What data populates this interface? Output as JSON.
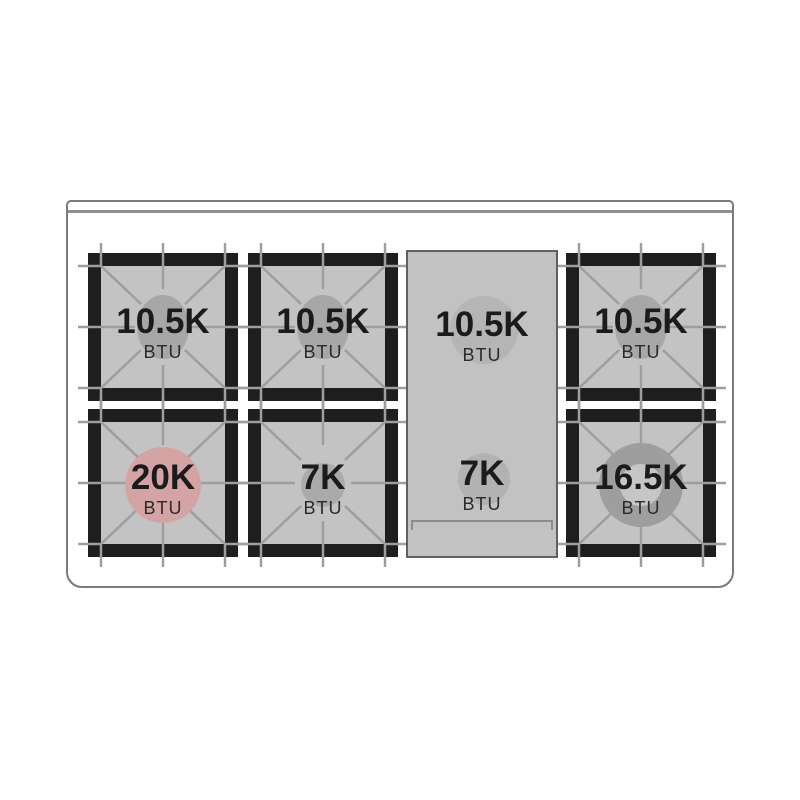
{
  "diagram": {
    "title": "Gas range cooktop burner layout",
    "unit": "BTU"
  },
  "burners": [
    {
      "position": "rear-left",
      "value": "10.5K",
      "unit": "BTU",
      "indicator": "gray-oval"
    },
    {
      "position": "rear-center-left",
      "value": "10.5K",
      "unit": "BTU",
      "indicator": "gray-oval"
    },
    {
      "position": "griddle-rear",
      "value": "10.5K",
      "unit": "BTU",
      "indicator": "gray-circle"
    },
    {
      "position": "rear-right",
      "value": "10.5K",
      "unit": "BTU",
      "indicator": "gray-oval"
    },
    {
      "position": "front-left",
      "value": "20K",
      "unit": "BTU",
      "indicator": "red-circle"
    },
    {
      "position": "front-center-left",
      "value": "7K",
      "unit": "BTU",
      "indicator": "gray-circle-small"
    },
    {
      "position": "griddle-front",
      "value": "7K",
      "unit": "BTU",
      "indicator": "gray-circle-small"
    },
    {
      "position": "front-right",
      "value": "16.5K",
      "unit": "BTU",
      "indicator": "gray-ring"
    }
  ],
  "colors": {
    "background": "#ffffff",
    "outline_gray": "#7a7a7a",
    "frame_black": "#1e1e1e",
    "panel_gray": "#c3c3c3",
    "grate_line_gray": "#9e9e9e",
    "burner_cap_gray": "#a7a7a7",
    "burner_cap_red": "#d4a4a4",
    "burner_ring_gray": "#9e9e9e",
    "text_black": "#1b1b1b"
  }
}
